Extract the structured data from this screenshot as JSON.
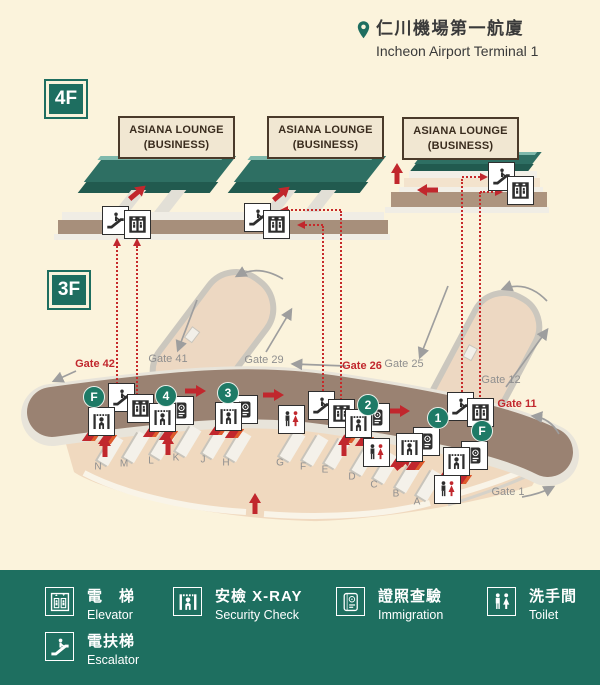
{
  "header": {
    "pin_icon": "location-pin",
    "title_zh": "仁川機場第一航廈",
    "title_en": "Incheon Airport Terminal 1"
  },
  "floor_labels": {
    "f4": "4F",
    "f3": "3F"
  },
  "lounge_label": {
    "line1": "ASIANA LOUNGE",
    "line2": "(BUSINESS)"
  },
  "lounge_positions": [
    {
      "x": 118,
      "y": 116
    },
    {
      "x": 267,
      "y": 116
    },
    {
      "x": 402,
      "y": 117
    }
  ],
  "gates": [
    {
      "label": "Gate 42",
      "color": "red",
      "x": 95,
      "y": 364
    },
    {
      "label": "Gate 41",
      "color": "gray",
      "x": 168,
      "y": 359
    },
    {
      "label": "Gate 29",
      "color": "gray",
      "x": 264,
      "y": 360
    },
    {
      "label": "Gate 26",
      "color": "red",
      "x": 362,
      "y": 366
    },
    {
      "label": "Gate 25",
      "color": "gray",
      "x": 404,
      "y": 364
    },
    {
      "label": "Gate 12",
      "color": "gray",
      "x": 501,
      "y": 380
    },
    {
      "label": "Gate 11",
      "color": "red",
      "x": 517,
      "y": 404
    },
    {
      "label": "Gate 1",
      "color": "gray",
      "x": 508,
      "y": 492
    }
  ],
  "checkin_counters": [
    {
      "letter": "N",
      "x": 98,
      "y": 467
    },
    {
      "letter": "M",
      "x": 124,
      "y": 464
    },
    {
      "letter": "L",
      "x": 151,
      "y": 461
    },
    {
      "letter": "K",
      "x": 176,
      "y": 458
    },
    {
      "letter": "J",
      "x": 203,
      "y": 460
    },
    {
      "letter": "H",
      "x": 226,
      "y": 463
    },
    {
      "letter": "G",
      "x": 280,
      "y": 463
    },
    {
      "letter": "F",
      "x": 303,
      "y": 467
    },
    {
      "letter": "E",
      "x": 325,
      "y": 470
    },
    {
      "letter": "D",
      "x": 352,
      "y": 477
    },
    {
      "letter": "C",
      "x": 374,
      "y": 485
    },
    {
      "letter": "B",
      "x": 396,
      "y": 494
    },
    {
      "letter": "A",
      "x": 417,
      "y": 502
    }
  ],
  "route_badges": [
    {
      "label": "F",
      "x": 93,
      "y": 396
    },
    {
      "label": "4",
      "x": 165,
      "y": 395
    },
    {
      "label": "3",
      "x": 227,
      "y": 392
    },
    {
      "label": "2",
      "x": 367,
      "y": 404
    },
    {
      "label": "1",
      "x": 437,
      "y": 417
    },
    {
      "label": "F",
      "x": 481,
      "y": 430
    }
  ],
  "facility_markers": [
    {
      "type": "escalator",
      "x": 115,
      "y": 220
    },
    {
      "type": "elevator",
      "x": 137,
      "y": 224
    },
    {
      "type": "escalator",
      "x": 257,
      "y": 217
    },
    {
      "type": "elevator",
      "x": 276,
      "y": 224
    },
    {
      "type": "escalator",
      "x": 501,
      "y": 176
    },
    {
      "type": "elevator",
      "x": 520,
      "y": 190
    },
    {
      "type": "escalator",
      "x": 121,
      "y": 397
    },
    {
      "type": "elevator",
      "x": 140,
      "y": 408
    },
    {
      "type": "security",
      "x": 101,
      "y": 421
    },
    {
      "type": "immigration",
      "x": 180,
      "y": 410
    },
    {
      "type": "security",
      "x": 162,
      "y": 417
    },
    {
      "type": "immigration",
      "x": 244,
      "y": 409
    },
    {
      "type": "security",
      "x": 228,
      "y": 416
    },
    {
      "type": "toilet",
      "x": 291,
      "y": 419
    },
    {
      "type": "escalator",
      "x": 321,
      "y": 405
    },
    {
      "type": "elevator",
      "x": 341,
      "y": 413
    },
    {
      "type": "immigration",
      "x": 376,
      "y": 417
    },
    {
      "type": "security",
      "x": 358,
      "y": 423
    },
    {
      "type": "immigration",
      "x": 426,
      "y": 441
    },
    {
      "type": "security",
      "x": 409,
      "y": 447
    },
    {
      "type": "escalator",
      "x": 460,
      "y": 406
    },
    {
      "type": "elevator",
      "x": 480,
      "y": 412
    },
    {
      "type": "immigration",
      "x": 474,
      "y": 455
    },
    {
      "type": "security",
      "x": 456,
      "y": 461
    },
    {
      "type": "toilet",
      "x": 376,
      "y": 452
    },
    {
      "type": "toilet",
      "x": 447,
      "y": 489
    }
  ],
  "dotted_routes": {
    "verticals": [
      [
        117,
        246,
        392
      ],
      [
        137,
        246,
        399
      ],
      [
        323,
        226,
        398
      ],
      [
        341,
        211,
        404
      ],
      [
        462,
        179,
        399
      ],
      [
        480,
        192,
        404
      ]
    ],
    "horizontals": [
      [
        210,
        283,
        341
      ],
      [
        225,
        300,
        323
      ],
      [
        177,
        462,
        484
      ],
      [
        192,
        480,
        500
      ]
    ],
    "arrowheads": [
      {
        "x": 117,
        "y": 238,
        "dir": "up"
      },
      {
        "x": 137,
        "y": 238,
        "dir": "up"
      },
      {
        "x": 280,
        "y": 210,
        "dir": "left"
      },
      {
        "x": 297,
        "y": 225,
        "dir": "left"
      },
      {
        "x": 488,
        "y": 177,
        "dir": "right"
      },
      {
        "x": 503,
        "y": 192,
        "dir": "right"
      }
    ]
  },
  "red_arrows": [
    {
      "x": 138,
      "y": 192,
      "dir": "up-right"
    },
    {
      "x": 282,
      "y": 193,
      "dir": "up-right"
    },
    {
      "x": 397,
      "y": 173,
      "dir": "up"
    },
    {
      "x": 427,
      "y": 190,
      "dir": "left"
    },
    {
      "x": 196,
      "y": 391,
      "dir": "right"
    },
    {
      "x": 274,
      "y": 395,
      "dir": "right"
    },
    {
      "x": 400,
      "y": 411,
      "dir": "right"
    },
    {
      "x": 105,
      "y": 446,
      "dir": "up"
    },
    {
      "x": 168,
      "y": 444,
      "dir": "up"
    },
    {
      "x": 344,
      "y": 445,
      "dir": "up"
    },
    {
      "x": 404,
      "y": 462,
      "dir": "up-right"
    },
    {
      "x": 255,
      "y": 503,
      "dir": "up"
    }
  ],
  "red_blocks": [
    [
      91,
      436
    ],
    [
      107,
      439
    ],
    [
      152,
      432
    ],
    [
      168,
      435
    ],
    [
      218,
      430
    ],
    [
      234,
      433
    ],
    [
      348,
      438
    ],
    [
      364,
      441
    ],
    [
      399,
      462
    ],
    [
      415,
      465
    ],
    [
      446,
      476
    ],
    [
      462,
      479
    ]
  ],
  "gray_arrows": [
    {
      "d": [
        197,
        300,
        178,
        350
      ]
    },
    {
      "d": [
        266,
        352,
        291,
        310
      ]
    },
    {
      "d": [
        283,
        279,
        258,
        264,
        237,
        276
      ]
    },
    {
      "d": [
        346,
        366,
        293,
        364
      ]
    },
    {
      "d": [
        448,
        286,
        420,
        357
      ]
    },
    {
      "d": [
        506,
        387,
        547,
        330
      ]
    },
    {
      "d": [
        547,
        301,
        527,
        280,
        503,
        289
      ]
    },
    {
      "d": [
        559,
        434,
        550,
        418,
        533,
        416
      ]
    },
    {
      "d": [
        522,
        497,
        540,
        494,
        553,
        487
      ]
    },
    {
      "d": [
        76,
        371,
        54,
        381
      ]
    }
  ],
  "legend": {
    "items": [
      {
        "type": "elevator",
        "zh": "電　梯",
        "en": "Elevator"
      },
      {
        "type": "escalator",
        "zh": "電扶梯",
        "en": "Escalator"
      },
      {
        "type": "security",
        "zh": "安檢 X-RAY",
        "en": "Security Check"
      },
      {
        "type": "immigration",
        "zh": "證照查驗",
        "en": "Immigration"
      },
      {
        "type": "toilet",
        "zh": "洗手間",
        "en": "Toilet"
      }
    ]
  },
  "colors": {
    "bg": "#FBF3DC",
    "green": "#1E6E60",
    "teal_top": "#2E6F63",
    "band": "#9A8272",
    "apron": "#F0D9BF",
    "red": "#C1272D",
    "gray_text": "#8F8F8F",
    "label_box_bg": "#F1E7D2",
    "label_box_border": "#4A3A2A",
    "icon_dark": "#2E2E2E"
  }
}
